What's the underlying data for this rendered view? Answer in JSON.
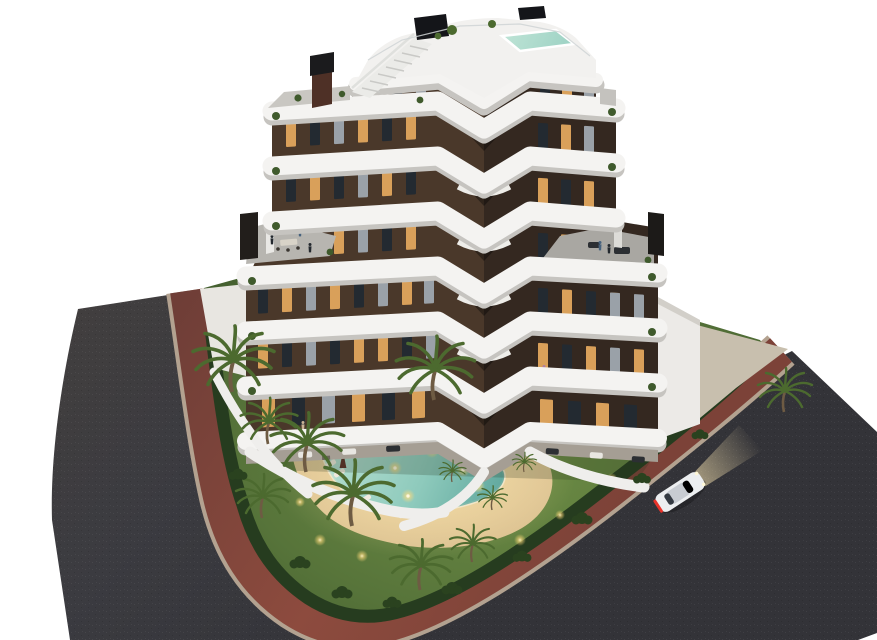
{
  "scene": {
    "title": "apartment-complex-dusk-aerial-render",
    "type": "architectural-3d-visualization",
    "time_of_day": "dusk",
    "building": {
      "floors_visible": 7,
      "style": "modern chevron block with white curved wrap-around balcony bands",
      "rooftop": [
        "roof terrace",
        "plunge pool",
        "black privacy screen",
        "staircase",
        "brick chimney"
      ],
      "terrace_level_features": [
        "two roof terraces with furniture",
        "two dark chimney cores"
      ],
      "ground_level": [
        "private patios with white privacy walls",
        "outdoor furniture"
      ]
    },
    "garden": {
      "features": [
        "free-form illuminated swimming pool",
        "sand-colored deck",
        "sun loungers",
        "folded parasols",
        "planting island with palm",
        "perimeter hedge",
        "palm trees",
        "garden uplights"
      ],
      "lounger_count": 8,
      "parasol_count": 2,
      "palm_count": 12
    },
    "roads": {
      "left_road": "dark asphalt, curving, runs top-left to bottom",
      "right_road": "dark asphalt, diagonal to bottom-right",
      "sidewalk": "red-brown paved band with light curbs wrapping the plot"
    },
    "car": {
      "color": "white",
      "state": "driving with headlights on",
      "lights": "red taillights"
    },
    "colors": {
      "background": "#ffffff",
      "asphalt": "#3b3b40",
      "sidewalk": "#82463a",
      "curb": "#b3a290",
      "lawn": "#57743a",
      "hedge": "#263c1f",
      "deck_sand": "#e0c99c",
      "pool_water": "#8ecabc",
      "pool_rim": "#f2e6c8",
      "facade_left": "#4a382a",
      "facade_right": "#342820",
      "band_white": "#f4f3f1",
      "band_shadow": "#c6c4c0",
      "window_lit": "#d9a05a",
      "window_dark": "#232a31",
      "window_curtain": "#9aa1a8",
      "terrace_floor": "#b7b5b0",
      "chimney": "#221e1b",
      "brick": "#4e3026",
      "palm_frond": "#4c6a2f",
      "palm_trunk": "#6e5b43",
      "car_body": "#eceef0",
      "taillight": "#e8332a",
      "headlight_glow": "#f7e3b0",
      "concrete": "#c8bfae",
      "light_warm": "#ffd97a",
      "parasol": "#5d3128",
      "lounger": "#efe9dd"
    }
  }
}
